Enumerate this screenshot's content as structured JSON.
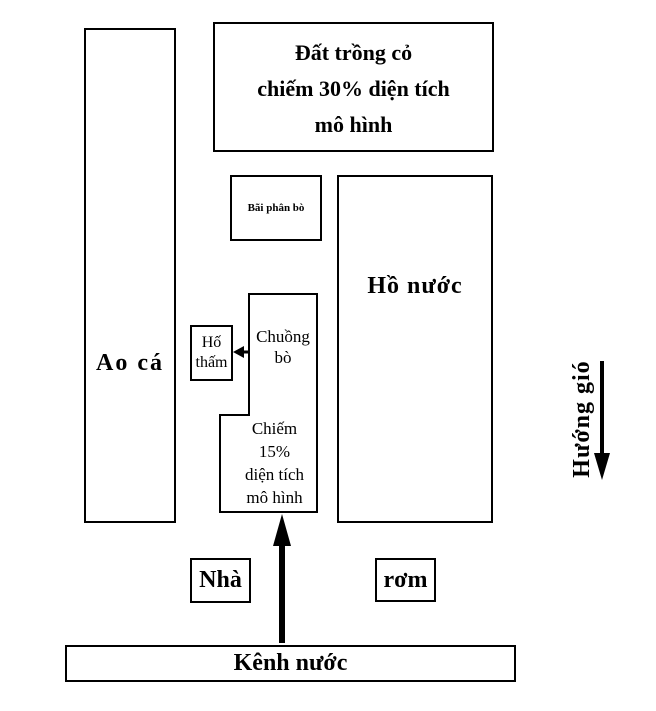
{
  "diagram": {
    "background_color": "#ffffff",
    "line_color": "#000000",
    "boxes": {
      "grass_plot": {
        "lines": [
          "Đất trồng cỏ",
          "chiếm 30% diện tích",
          "mô hình"
        ]
      },
      "fish_pond": {
        "label": "Ao cá"
      },
      "manure_yard": {
        "label": "Bãi phân bò"
      },
      "water_lake": {
        "label": "Hồ nước"
      },
      "soak_pit": {
        "lines": [
          "Hố",
          "thấm"
        ]
      },
      "cow_barn": {
        "lines": [
          "Chuồng",
          "bò"
        ],
        "area_note_lines": [
          "Chiếm",
          "15%",
          "diện tích",
          "mô hình"
        ]
      },
      "house": {
        "label": "Nhà"
      },
      "straw": {
        "label": "rơm"
      },
      "water_canal": {
        "label": "Kênh nước"
      }
    },
    "wind_direction": {
      "label": "Hướng gió"
    }
  }
}
